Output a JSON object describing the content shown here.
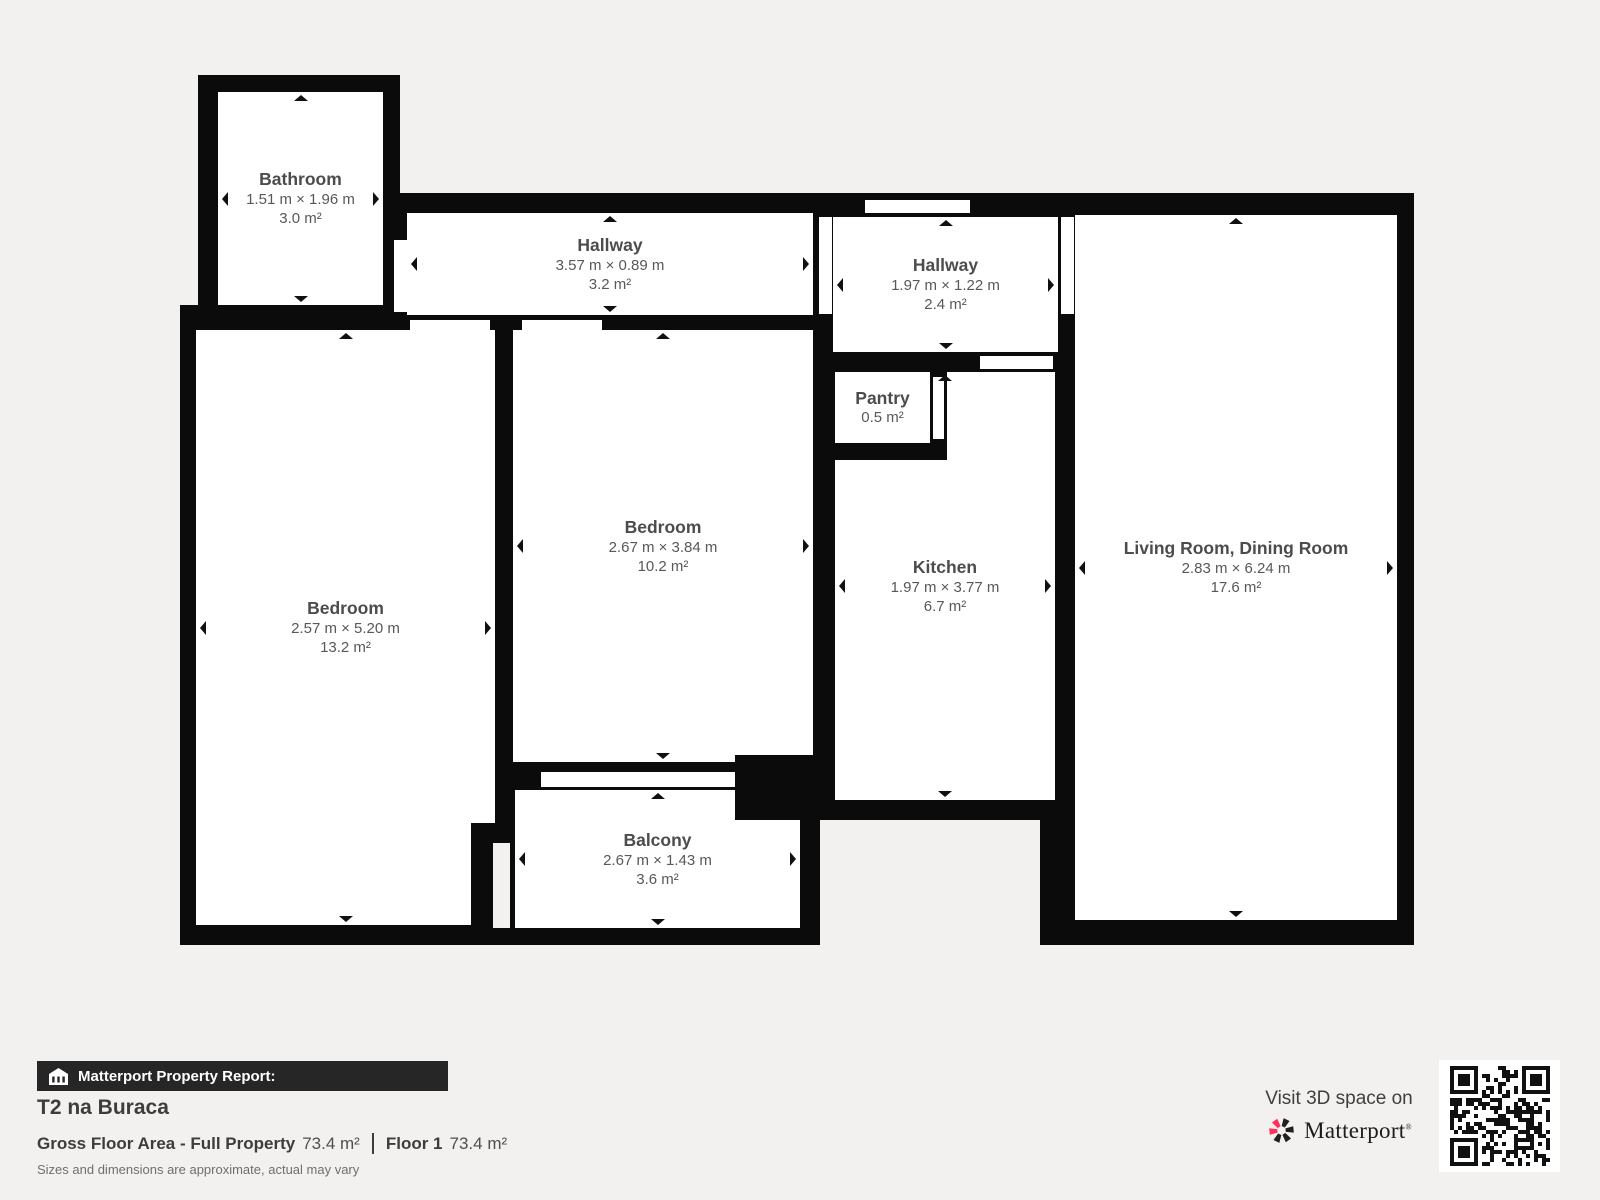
{
  "rooms": [
    {
      "id": "bathroom",
      "name": "Bathroom",
      "dimensions": "1.51 m × 1.96 m",
      "area": "3.0 m²"
    },
    {
      "id": "hallway-top",
      "name": "Hallway",
      "dimensions": "3.57 m × 0.89 m",
      "area": "3.2 m²"
    },
    {
      "id": "hallway-right",
      "name": "Hallway",
      "dimensions": "1.97 m × 1.22 m",
      "area": "2.4 m²"
    },
    {
      "id": "pantry",
      "name": "Pantry",
      "dimensions": "",
      "area": "0.5 m²"
    },
    {
      "id": "bedroom-left",
      "name": "Bedroom",
      "dimensions": "2.57 m × 5.20 m",
      "area": "13.2 m²"
    },
    {
      "id": "bedroom-center",
      "name": "Bedroom",
      "dimensions": "2.67 m × 3.84 m",
      "area": "10.2 m²"
    },
    {
      "id": "kitchen",
      "name": "Kitchen",
      "dimensions": "1.97 m × 3.77 m",
      "area": "6.7 m²"
    },
    {
      "id": "living-room",
      "name": "Living Room, Dining Room",
      "dimensions": "2.83 m × 6.24 m",
      "area": "17.6 m²"
    },
    {
      "id": "balcony",
      "name": "Balcony",
      "dimensions": "2.67 m × 1.43 m",
      "area": "3.6 m²"
    }
  ],
  "footer": {
    "report_label": "Matterport Property Report:",
    "property_name": "T2 na Buraca",
    "gross_area_label": "Gross Floor Area - Full Property",
    "gross_area_value": "73.4 m²",
    "floor_label": "Floor 1",
    "floor_value": "73.4 m²",
    "disclaimer": "Sizes and dimensions are approximate, actual may vary"
  },
  "cta": {
    "visit_text": "Visit 3D space on",
    "brand": "Matterport",
    "brand_mark": "®"
  },
  "colors": {
    "background": "#f2f1ef",
    "wall": "#0b0b0b",
    "floor": "#ffffff",
    "footer_bar": "#262626",
    "brand_red": "#ff3158",
    "brand_black": "#231f20"
  }
}
